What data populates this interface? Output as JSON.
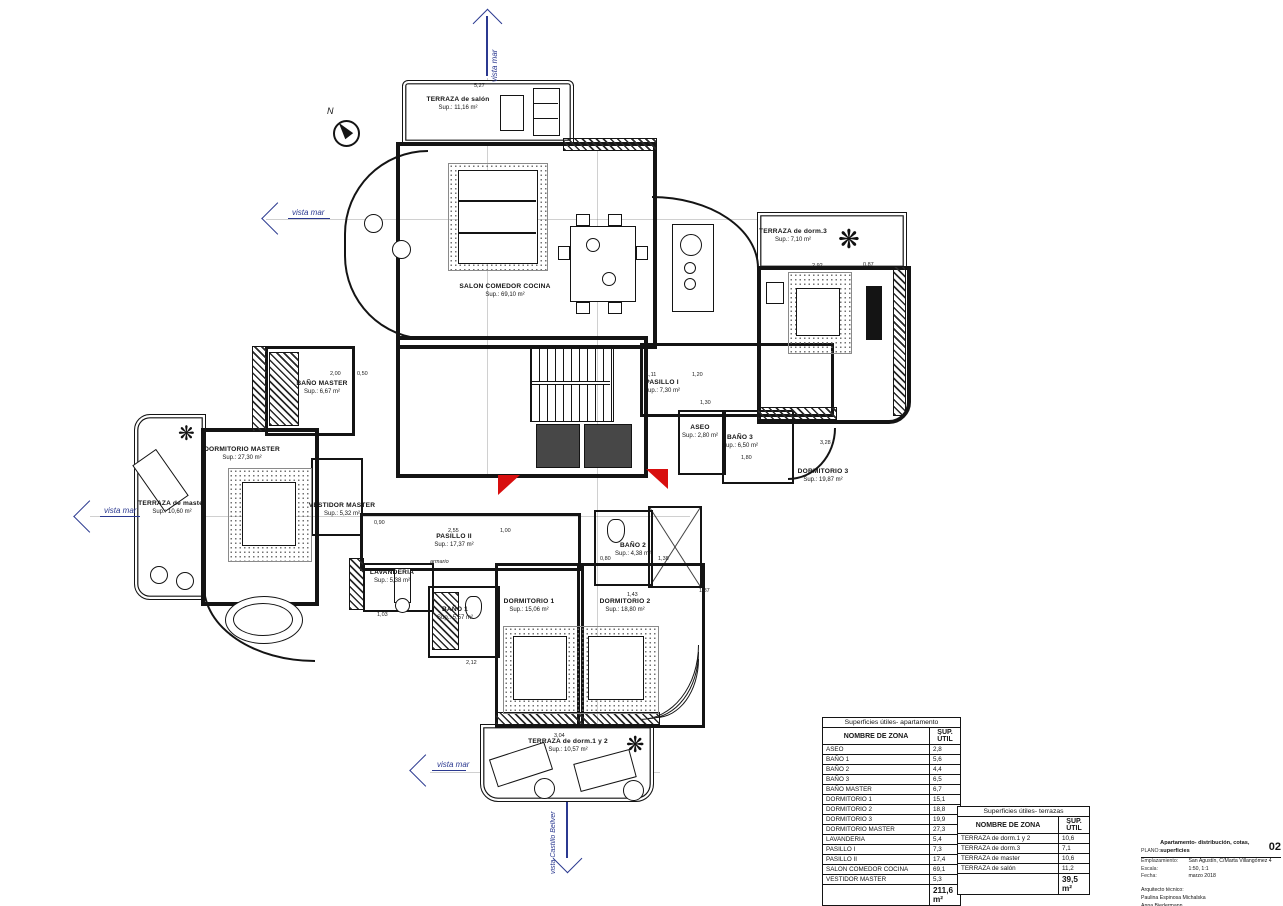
{
  "meta": {
    "accent_blue": "#2b3990",
    "accent_red": "#d80e0e",
    "ink": "#141414",
    "paper": "#ffffff"
  },
  "compass": {
    "label": "N"
  },
  "views": [
    {
      "label": "vista mar"
    },
    {
      "label": "vista mar"
    },
    {
      "label": "vista mar"
    },
    {
      "label": "vista mar"
    },
    {
      "label": "vista Castillo Bellver"
    }
  ],
  "rooms": [
    {
      "name": "TERRAZA de salón",
      "sup": "Sup.: 11,16 m²"
    },
    {
      "name": "SALON COMEDOR COCINA",
      "sup": "Sup.: 69,10 m²"
    },
    {
      "name": "TERRAZA de dorm.3",
      "sup": "Sup.: 7,10 m²"
    },
    {
      "name": "DORMITORIO 3",
      "sup": "Sup.: 19,87 m²"
    },
    {
      "name": "BAÑO MASTER",
      "sup": "Sup.: 6,67 m²"
    },
    {
      "name": "PASILLO I",
      "sup": "Sup.: 7,30 m²"
    },
    {
      "name": "ASEO",
      "sup": "Sup.: 2,80 m²"
    },
    {
      "name": "BAÑO 3",
      "sup": "Sup.: 6,50 m²"
    },
    {
      "name": "DORMITORIO MASTER",
      "sup": "Sup.: 27,30 m²"
    },
    {
      "name": "TERRAZA de master",
      "sup": "Sup.: 10,60 m²"
    },
    {
      "name": "VESTIDOR MASTER",
      "sup": "Sup.: 5,32 m²"
    },
    {
      "name": "PASILLO II",
      "sup": "Sup.: 17,37 m²"
    },
    {
      "name": "LAVANDERIA",
      "sup": "Sup.: 5,38 m²"
    },
    {
      "name": "BAÑO 1",
      "sup": "Sup.: 5,57 m²"
    },
    {
      "name": "BAÑO 2",
      "sup": "Sup.: 4,38 m²"
    },
    {
      "name": "DORMITORIO 1",
      "sup": "Sup.: 15,06 m²"
    },
    {
      "name": "DORMITORIO 2",
      "sup": "Sup.: 18,80 m²"
    },
    {
      "name": "TERRAZA de dorm.1 y 2",
      "sup": "Sup.: 10,57 m²"
    }
  ],
  "small_labels": {
    "closet": "armario"
  },
  "dims": [
    "5,27",
    "2,00",
    "0,50",
    "1,11",
    "1,20",
    "1,30",
    "2,92",
    "0,87",
    "3,28",
    "2,55",
    "1,00",
    "0,90",
    "1,03",
    "2,12",
    "1,43",
    "0,80",
    "1,38",
    "1,80",
    "1,87",
    "3,04"
  ],
  "tables": {
    "apartment": {
      "title": "Superficies útiles- apartamento",
      "col_zone": "NOMBRE DE ZONA",
      "col_sup": "SUP. ÚTIL",
      "rows": [
        {
          "zone": "ASEO",
          "sup": "2,8"
        },
        {
          "zone": "BAÑO 1",
          "sup": "5,6"
        },
        {
          "zone": "BAÑO 2",
          "sup": "4,4"
        },
        {
          "zone": "BAÑO 3",
          "sup": "6,5"
        },
        {
          "zone": "BAÑO MASTER",
          "sup": "6,7"
        },
        {
          "zone": "DORMITORIO 1",
          "sup": "15,1"
        },
        {
          "zone": "DORMITORIO 2",
          "sup": "18,8"
        },
        {
          "zone": "DORMITORIO 3",
          "sup": "19,9"
        },
        {
          "zone": "DORMITORIO MASTER",
          "sup": "27,3"
        },
        {
          "zone": "LAVANDERIA",
          "sup": "5,4"
        },
        {
          "zone": "PASILLO I",
          "sup": "7,3"
        },
        {
          "zone": "PASILLO II",
          "sup": "17,4"
        },
        {
          "zone": "SALON COMEDOR COCINA",
          "sup": "69,1"
        },
        {
          "zone": "VESTIDOR MASTER",
          "sup": "5,3"
        }
      ],
      "total": "211,6 m²"
    },
    "terraces": {
      "title": "Superficies útiles- terrazas",
      "col_zone": "NOMBRE DE ZONA",
      "col_sup": "SUP. ÚTIL",
      "rows": [
        {
          "zone": "TERRAZA de dorm.1 y 2",
          "sup": "10,6"
        },
        {
          "zone": "TERRAZA de dorm.3",
          "sup": "7,1"
        },
        {
          "zone": "TERRAZA de master",
          "sup": "10,6"
        },
        {
          "zone": "TERRAZA de salón",
          "sup": "11,2"
        }
      ],
      "total": "39,5 m²"
    }
  },
  "titleblock": {
    "sheet_label": "PLANO:",
    "sheet_title": "Apartamento- distribución, cotas, superficies",
    "sheet_no": "02",
    "site_label": "Emplazamiento:",
    "site": "San Agustín, C/Marta Villangómez 4",
    "scale_label": "Escala:",
    "scale": "1:50, 1:1",
    "date_label": "Fecha:",
    "date": "marzo 2018",
    "authors_label": "Arquitecto técnico:",
    "author1": "Paulina Espinosa Michalska",
    "author2": "Anna Biedermann"
  }
}
